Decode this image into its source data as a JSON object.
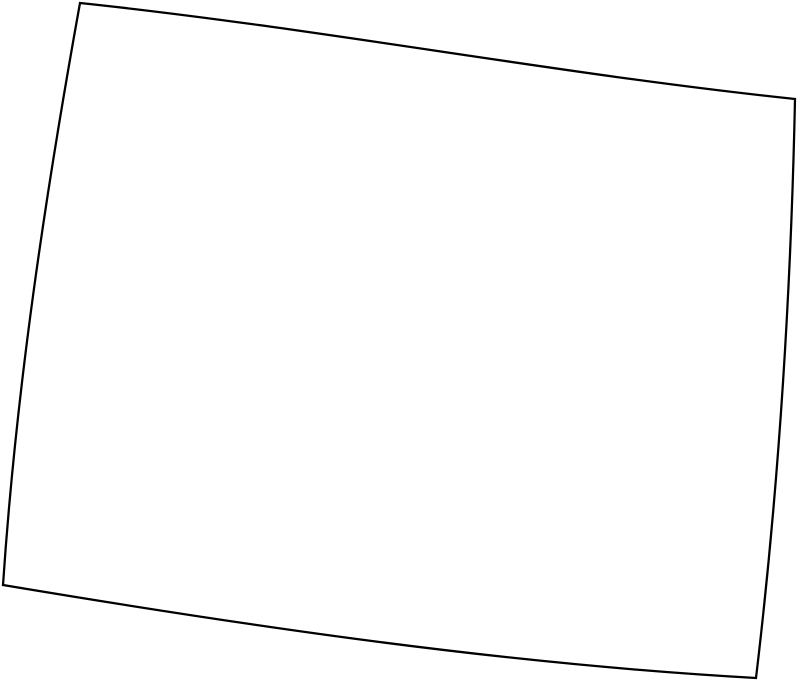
{
  "canvas": {
    "width": 800,
    "height": 683,
    "background_color": "#ffffff"
  },
  "map": {
    "shape_name": "us-state-outline",
    "outline_path": "M 80,3 C 318,28 557,74 795,99 C 791,292 779,485 756,678 C 505,664 254,627 3,585 C 16,391 45,197 80,3 Z",
    "stroke_color": "#000000",
    "fill_color": "#ffffff",
    "stroke_width": "2.25"
  }
}
